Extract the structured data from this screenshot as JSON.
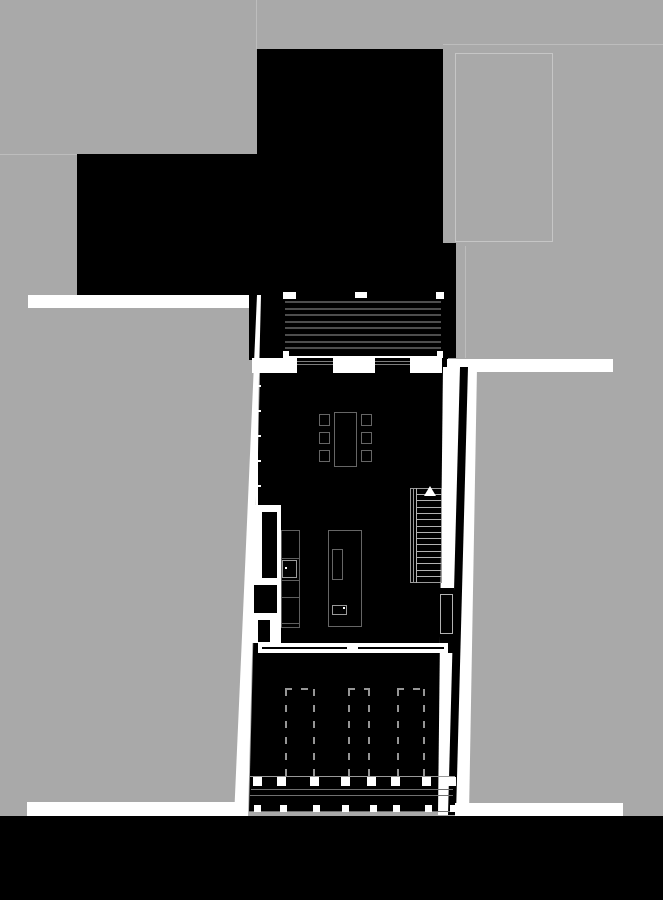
{
  "meta": {
    "title": "Architectural ground-floor site plan",
    "drawing_type": "floor-plan",
    "orientation": "portrait"
  },
  "palette": {
    "background_gray": "#a9a9a9",
    "plan_black": "#000000",
    "paper_white": "#ffffff",
    "faint_line": "#bdbdbd",
    "neighbor_outline": "#c6c6c6",
    "roof_stripe": "#4d4d4d",
    "glazing_line": "#7d7d7d",
    "furniture_line": "#666666",
    "fixture_line": "#9a9a9a",
    "counter_line": "#5f5f5f",
    "tread_line": "#b2b2b2",
    "dash_line": "#969696",
    "deck_line": "#707070",
    "deck_line2": "#999999"
  },
  "counts": {
    "roof_stripes": 8,
    "window_panels": 2,
    "dining_chairs": 6,
    "stair_treads": 14,
    "parking_stalls": 3,
    "deck_posts_row1": 8,
    "deck_posts_row2": 8,
    "wall_ticks": 5
  },
  "repeats": {
    "roof_stripes": {
      "x": 285,
      "w": 156,
      "y0": 301,
      "step": 6.6,
      "h": 2,
      "count": 8,
      "color_key": "roof_stripe"
    },
    "stair_treads": {
      "x": 417,
      "w": 25,
      "y0": 494,
      "step": 6.3,
      "h": 1,
      "count": 14,
      "color_key": "tread_line"
    },
    "chairs": {
      "xs": [
        319,
        361
      ],
      "ys": [
        414,
        432,
        450
      ],
      "w": 11,
      "h": 12,
      "color_key": "furniture_line"
    },
    "stalls": [
      {
        "x": 285,
        "w": 30,
        "y": 688,
        "h": 89
      },
      {
        "x": 348,
        "w": 22,
        "y": 688,
        "h": 89
      },
      {
        "x": 397,
        "w": 28,
        "y": 688,
        "h": 89
      }
    ],
    "posts_row1": {
      "y": 777,
      "size": 9,
      "xs": [
        253,
        277,
        310,
        341,
        367,
        391,
        422,
        447
      ]
    },
    "posts_row2": {
      "y": 805,
      "size": 7,
      "xs": [
        254,
        280,
        313,
        342,
        370,
        393,
        425,
        450
      ]
    },
    "wall_ticks": {
      "x": 257,
      "w": 4,
      "h": 2,
      "ys": [
        385,
        410,
        435,
        460,
        485
      ]
    },
    "glazing_panels": [
      {
        "x": 297,
        "y": 358,
        "w": 36,
        "h": 15
      },
      {
        "x": 375,
        "y": 358,
        "w": 35,
        "h": 15
      }
    ]
  },
  "shapes": [
    {
      "n": "parcel-line-north",
      "t": "rect",
      "x": 256,
      "y": 0,
      "w": 1,
      "h": 49,
      "ck": "faint_line"
    },
    {
      "n": "parcel-line-west",
      "t": "rect",
      "x": 0,
      "y": 154,
      "w": 77,
      "h": 1,
      "ck": "faint_line"
    },
    {
      "n": "parcel-line-northeast",
      "t": "rect",
      "x": 443,
      "y": 44,
      "w": 220,
      "h": 1,
      "ck": "faint_line"
    },
    {
      "n": "neighbor-building-outline",
      "t": "outline",
      "x": 455,
      "y": 53,
      "w": 98,
      "h": 189,
      "ck": "neighbor_outline"
    },
    {
      "n": "parcel-line-east",
      "t": "rect",
      "x": 465,
      "y": 246,
      "w": 1,
      "h": 112,
      "ck": "faint_line"
    },
    {
      "n": "building-mass-north",
      "t": "rect",
      "x": 257,
      "y": 49,
      "w": 186,
      "h": 246,
      "ck": "plan_black"
    },
    {
      "n": "building-mass-west",
      "t": "rect",
      "x": 77,
      "y": 154,
      "w": 180,
      "h": 141,
      "ck": "plan_black"
    },
    {
      "n": "building-mass-east-strip",
      "t": "rect",
      "x": 443,
      "y": 243,
      "w": 13,
      "h": 115,
      "ck": "plan_black"
    },
    {
      "n": "sidewalk-northwest",
      "t": "rect",
      "x": 28,
      "y": 295,
      "w": 222,
      "h": 13,
      "ck": "paper_white"
    },
    {
      "n": "building-mass-west-strip",
      "t": "rect",
      "x": 249,
      "y": 295,
      "w": 34,
      "h": 65,
      "ck": "plan_black"
    },
    {
      "n": "walkway-west",
      "t": "poly",
      "pts": [
        [
          257,
          295
        ],
        [
          261,
          295
        ],
        [
          248,
          818
        ],
        [
          234,
          818
        ]
      ],
      "ck": "paper_white"
    },
    {
      "n": "sidewalk-southwest",
      "t": "rect",
      "x": 27,
      "y": 802,
      "w": 220,
      "h": 16,
      "ck": "paper_white"
    },
    {
      "n": "roof-stripe-panel",
      "t": "rect",
      "x": 283,
      "y": 295,
      "w": 160,
      "h": 61,
      "ck": "plan_black"
    },
    {
      "n": "roof-corner-mark-nw",
      "t": "rect",
      "x": 283,
      "y": 292,
      "w": 13,
      "h": 7,
      "ck": "paper_white"
    },
    {
      "n": "roof-corner-mark-n",
      "t": "rect",
      "x": 355,
      "y": 292,
      "w": 12,
      "h": 6,
      "ck": "paper_white"
    },
    {
      "n": "roof-corner-mark-ne",
      "t": "rect",
      "x": 436,
      "y": 292,
      "w": 8,
      "h": 7,
      "ck": "paper_white"
    },
    {
      "n": "roof-corner-mark-sw",
      "t": "rect",
      "x": 283,
      "y": 351,
      "w": 6,
      "h": 10,
      "ck": "paper_white"
    },
    {
      "n": "roof-corner-mark-se",
      "t": "rect",
      "x": 437,
      "y": 351,
      "w": 6,
      "h": 10,
      "ck": "paper_white"
    },
    {
      "n": "roof-edge-line",
      "t": "rect",
      "x": 285,
      "y": 356,
      "w": 157,
      "h": 2,
      "ck": "paper_white"
    },
    {
      "n": "window-band-north",
      "t": "rect",
      "x": 252,
      "y": 358,
      "w": 196,
      "h": 15,
      "ck": "paper_white"
    },
    {
      "n": "window-band-corner-col",
      "t": "rect",
      "x": 442,
      "y": 358,
      "w": 6,
      "h": 15,
      "ck": "plan_black"
    },
    {
      "n": "sidewalk-east",
      "t": "rect",
      "x": 447,
      "y": 359,
      "w": 166,
      "h": 13,
      "ck": "paper_white"
    },
    {
      "n": "main-building-floor",
      "t": "poly",
      "pts": [
        [
          260,
          373
        ],
        [
          443,
          373
        ],
        [
          440,
          812
        ],
        [
          249,
          812
        ]
      ],
      "ck": "plan_black"
    },
    {
      "n": "walkway-east",
      "t": "poly",
      "pts": [
        [
          443,
          367
        ],
        [
          477,
          367
        ],
        [
          469,
          815
        ],
        [
          438,
          815
        ]
      ],
      "ck": "paper_white"
    },
    {
      "n": "right-wall-gap",
      "t": "rect",
      "x": 440,
      "y": 588,
      "w": 14,
      "h": 65,
      "ck": "plan_black"
    },
    {
      "n": "garden-fence-east",
      "t": "poly",
      "pts": [
        [
          460,
          367
        ],
        [
          468,
          367
        ],
        [
          456,
          815
        ],
        [
          448,
          815
        ]
      ],
      "ck": "plan_black"
    },
    {
      "n": "sidewalk-southeast",
      "t": "rect",
      "x": 455,
      "y": 803,
      "w": 168,
      "h": 15,
      "ck": "paper_white"
    },
    {
      "n": "west-facade-line",
      "t": "rect",
      "x": 256,
      "y": 373,
      "w": 2,
      "h": 132,
      "ck": "paper_white"
    },
    {
      "n": "entry-recess",
      "t": "rect",
      "x": 248,
      "y": 505,
      "w": 33,
      "h": 138,
      "ck": "paper_white"
    },
    {
      "n": "closet-box",
      "t": "rect",
      "x": 262,
      "y": 512,
      "w": 15,
      "h": 66,
      "ck": "plan_black"
    },
    {
      "n": "storage-box",
      "t": "rect",
      "x": 254,
      "y": 585,
      "w": 23,
      "h": 28,
      "ck": "plan_black"
    },
    {
      "n": "entry-door-leaf",
      "t": "rect",
      "x": 258,
      "y": 620,
      "w": 12,
      "h": 22,
      "ck": "plan_black"
    },
    {
      "n": "kitchen-counter",
      "t": "outline",
      "x": 281,
      "y": 530,
      "w": 19,
      "h": 98,
      "ck": "counter_line"
    },
    {
      "n": "counter-divider-1",
      "t": "rect",
      "x": 281,
      "y": 558,
      "w": 19,
      "h": 1,
      "ck": "counter_line"
    },
    {
      "n": "counter-divider-2",
      "t": "rect",
      "x": 281,
      "y": 580,
      "w": 19,
      "h": 1,
      "ck": "counter_line"
    },
    {
      "n": "counter-divider-3",
      "t": "rect",
      "x": 281,
      "y": 597,
      "w": 19,
      "h": 1,
      "ck": "counter_line"
    },
    {
      "n": "counter-divider-4",
      "t": "rect",
      "x": 281,
      "y": 623,
      "w": 19,
      "h": 1,
      "ck": "counter_line"
    },
    {
      "n": "counter-sink",
      "t": "outline",
      "x": 282,
      "y": 560,
      "w": 15,
      "h": 18,
      "ck": "fixture_line"
    },
    {
      "n": "counter-sink-faucet-dot",
      "t": "rect",
      "x": 285,
      "y": 567,
      "w": 2,
      "h": 2,
      "ck": "paper_white"
    },
    {
      "n": "kitchen-island",
      "t": "outline",
      "x": 328,
      "y": 530,
      "w": 34,
      "h": 97,
      "ck": "furniture_line"
    },
    {
      "n": "island-cooktop",
      "t": "outline",
      "x": 332,
      "y": 549,
      "w": 11,
      "h": 31,
      "ck": "furniture_line"
    },
    {
      "n": "island-sink",
      "t": "outline",
      "x": 332,
      "y": 605,
      "w": 15,
      "h": 10,
      "ck": "fixture_line"
    },
    {
      "n": "island-sink-faucet-dot",
      "t": "rect",
      "x": 343,
      "y": 607,
      "w": 2,
      "h": 2,
      "ck": "paper_white"
    },
    {
      "n": "dining-table",
      "t": "outline",
      "x": 334,
      "y": 412,
      "w": 23,
      "h": 55,
      "ck": "furniture_line"
    },
    {
      "n": "stair-frame",
      "t": "outline",
      "x": 410,
      "y": 488,
      "w": 32,
      "h": 95,
      "ck": "fixture_line"
    },
    {
      "n": "stair-stringer-1",
      "t": "rect",
      "x": 413,
      "y": 488,
      "w": 1,
      "h": 95,
      "ck": "fixture_line"
    },
    {
      "n": "stair-stringer-2",
      "t": "rect",
      "x": 416,
      "y": 488,
      "w": 1,
      "h": 95,
      "ck": "tread_line"
    },
    {
      "n": "stair-direction-arrow",
      "t": "tri",
      "x": 424,
      "y": 486,
      "w": 12,
      "h": 10,
      "ck": "paper_white"
    },
    {
      "n": "wc-fixture-box",
      "t": "outline2",
      "x": 440,
      "y": 594,
      "w": 13,
      "h": 40,
      "ck": "tread_line"
    },
    {
      "n": "south-wall-band",
      "t": "rect",
      "x": 258,
      "y": 643,
      "w": 190,
      "h": 10,
      "ck": "paper_white"
    },
    {
      "n": "south-wall-line-west",
      "t": "rect",
      "x": 262,
      "y": 647,
      "w": 85,
      "h": 2,
      "ck": "plan_black"
    },
    {
      "n": "south-wall-line-east",
      "t": "rect",
      "x": 358,
      "y": 647,
      "w": 86,
      "h": 2,
      "ck": "plan_black"
    },
    {
      "n": "deck-edge-line-1",
      "t": "rect",
      "x": 250,
      "y": 776,
      "w": 205,
      "h": 1,
      "ck": "deck_line2"
    },
    {
      "n": "deck-edge-line-2",
      "t": "rect",
      "x": 251,
      "y": 789,
      "w": 202,
      "h": 1,
      "ck": "deck_line"
    },
    {
      "n": "deck-edge-line-3",
      "t": "rect",
      "x": 250,
      "y": 795,
      "w": 203,
      "h": 1,
      "ck": "deck_line"
    },
    {
      "n": "deck-edge-line-4",
      "t": "rect",
      "x": 249,
      "y": 811,
      "w": 206,
      "h": 1,
      "ck": "deck_line"
    },
    {
      "n": "street-band-south",
      "t": "rect",
      "x": 0,
      "y": 816,
      "w": 663,
      "h": 84,
      "ck": "plan_black"
    }
  ]
}
